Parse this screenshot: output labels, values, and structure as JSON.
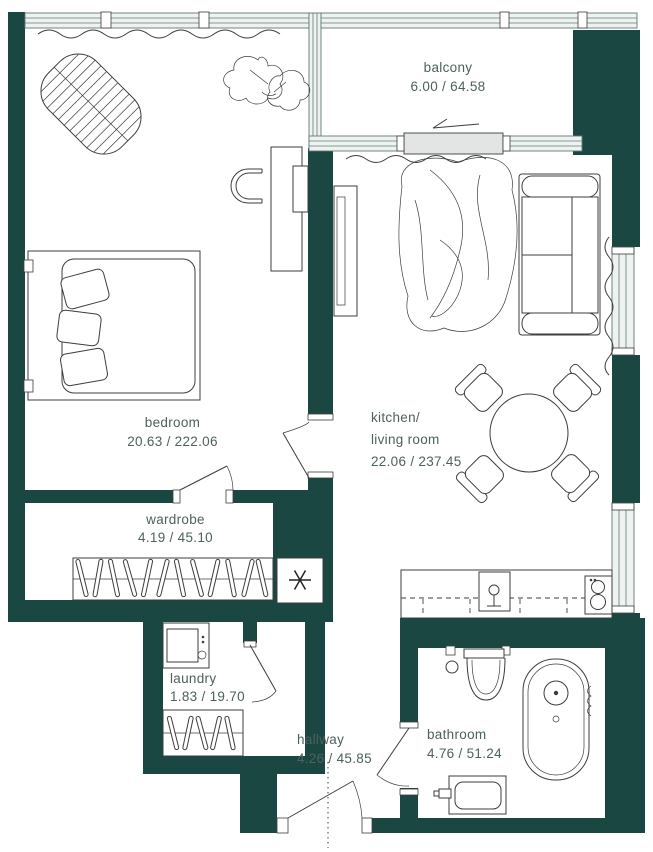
{
  "plan": {
    "colors": {
      "background": "#ffffff",
      "wall": "#1b4742",
      "line": "#3d3d3d",
      "label": "#4d615e",
      "window_fill": "#eef3f2",
      "window_line": "#5f7a76",
      "door_panel": "#e3e5e4"
    },
    "rooms": {
      "balcony": {
        "name": "balcony",
        "area": "6.00 / 64.58"
      },
      "bedroom": {
        "name": "bedroom",
        "area": "20.63 / 222.06"
      },
      "kitchen_living": {
        "name_line1": "kitchen/",
        "name_line2": "living room",
        "area": "22.06 / 237.45"
      },
      "wardrobe": {
        "name": "wardrobe",
        "area": "4.19 / 45.10"
      },
      "laundry": {
        "name": "laundry",
        "area": "1.83 / 19.70"
      },
      "hallway": {
        "name": "hallway",
        "area": "4.26 / 45.85"
      },
      "bathroom": {
        "name": "bathroom",
        "area": "4.76 / 51.24"
      }
    },
    "icons": {
      "shaft": "asterisk",
      "balcony_entry": "left-arrow"
    }
  }
}
